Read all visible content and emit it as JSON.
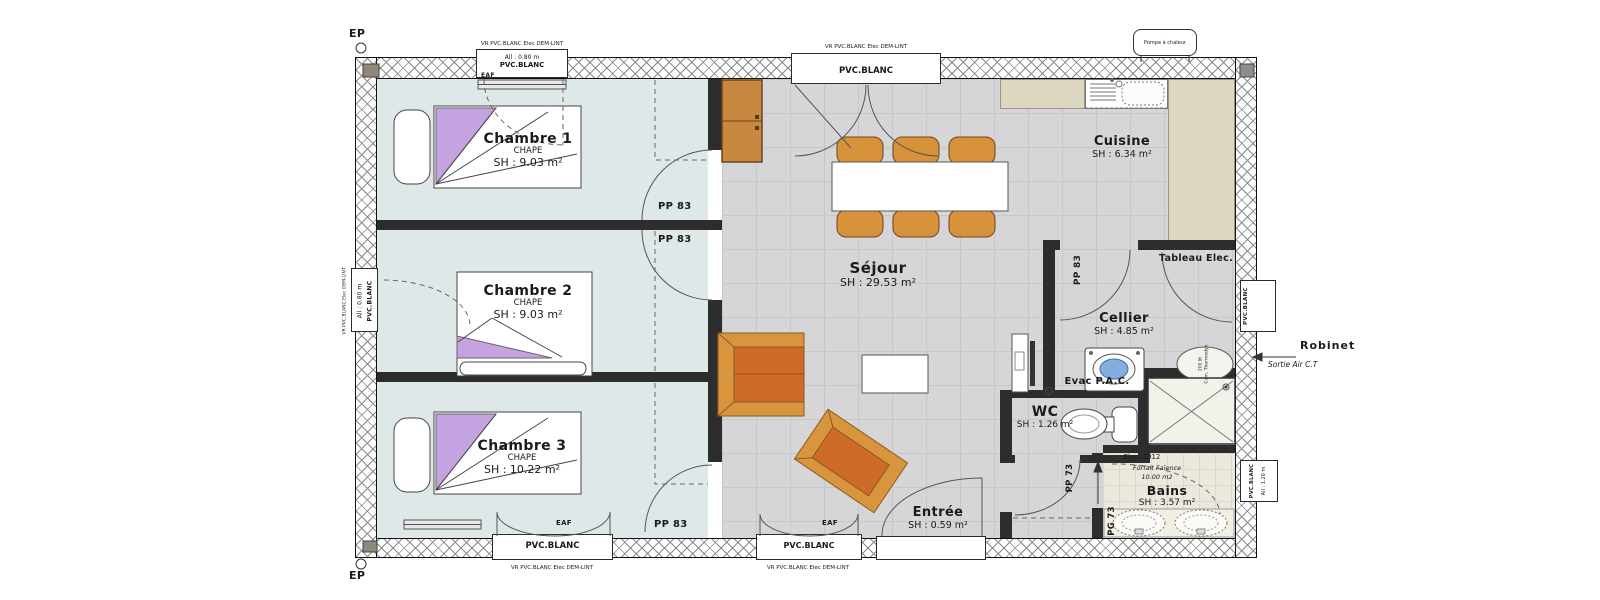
{
  "plan": {
    "rooms": [
      {
        "id": "chambre-1",
        "name": "Chambre 1",
        "screed": "CHAPE",
        "area": "SH : 9.03 m²"
      },
      {
        "id": "chambre-2",
        "name": "Chambre 2",
        "screed": "CHAPE",
        "area": "SH : 9.03 m²"
      },
      {
        "id": "chambre-3",
        "name": "Chambre 3",
        "screed": "CHAPE",
        "area": "SH : 10.22 m²"
      },
      {
        "id": "sejour",
        "name": "Séjour",
        "area": "SH : 29.53 m²"
      },
      {
        "id": "cuisine",
        "name": "Cuisine",
        "area": "SH : 6.34 m²"
      },
      {
        "id": "cellier",
        "name": "Cellier",
        "area": "SH : 4.85 m²"
      },
      {
        "id": "wc",
        "name": "WC",
        "area": "SH : 1.26 m²"
      },
      {
        "id": "bains",
        "name": "Bains",
        "area": "SH : 3.57 m²"
      },
      {
        "id": "entree",
        "name": "Entrée",
        "area": "SH : 0.59 m²"
      }
    ],
    "door_labels": {
      "pp83": "PP 83",
      "pp73": "PP 73",
      "pg73": "PG 73"
    },
    "window_labels": {
      "vr_note": "VR PVC.BLANC Elec DEM-LINT",
      "pvc": "PVC.BLANC",
      "allege_080": "All : 0.80 m",
      "allege_120": "All : 1.20 m",
      "eaf": "EAF"
    },
    "annotations": {
      "ep": "EP",
      "tableau_elec": "Tableau Elec.",
      "evac_pac": "Evac P.A.C.",
      "robinet": "Robinet",
      "sortie_air": "Sortie Air C.T",
      "pompe_chaleur": "Pompe à chaleur",
      "elec_2012": "Elec. 2012",
      "faience_line1": "Forfait Faïence",
      "faience_line2": "10.00 m2",
      "heater_line1": "200 lit",
      "heater_line2": "Cum. Thermodyn"
    },
    "colors": {
      "bedroom_floor": "#dfe8e8",
      "tile_floor": "#d6d6d8",
      "bath_floor": "#ebe9dd",
      "counter": "#ddd7bf",
      "wall": "#2d2d2d",
      "furniture_light": "#d9953d",
      "furniture_dark": "#cf6b28",
      "accent_purple": "#c5a3e0",
      "washer_blue": "#85aede"
    }
  }
}
